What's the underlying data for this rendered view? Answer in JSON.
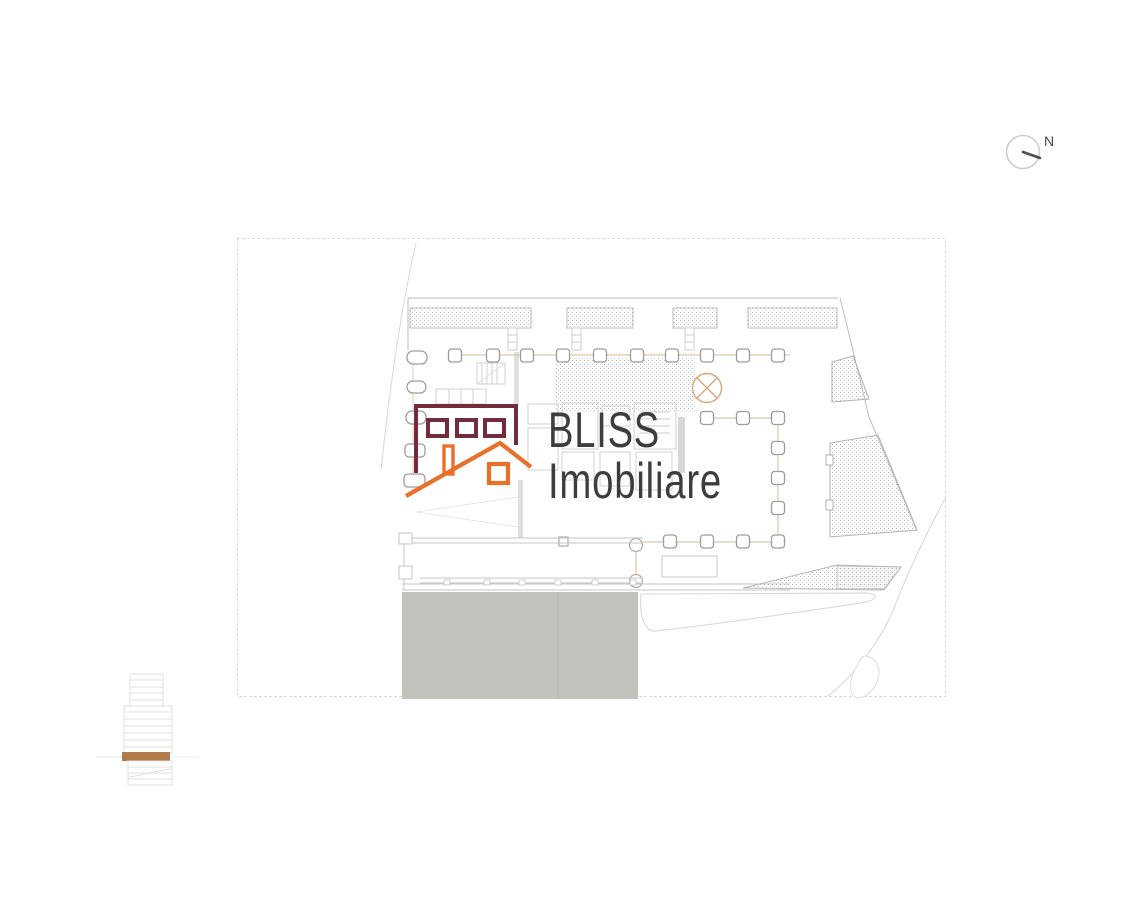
{
  "page": {
    "background_color": "#ffffff"
  },
  "watermark": {
    "line1": "BLISS",
    "line2": "Imobiliare",
    "text_color": "#3d3d3d",
    "house": {
      "building_color": "#722c3c",
      "roof_color": "#e8702a"
    }
  },
  "compass": {
    "label": "N",
    "label_color": "#4a4a4a",
    "ring_color": "#cdcdcd",
    "needle_color": "#4f4f4f"
  },
  "plan": {
    "boundary_color": "#c9c9c9",
    "slab_color": "#c3c2bd",
    "column_stroke_color": "#9d9d9d",
    "grid_line_color": "#ddb592",
    "hatch_dot_color": "#b3b3b3",
    "wall_color": "#c6c6c6"
  },
  "elevation_key": {
    "highlight_color": "#b07c4c",
    "line_color": "#e2e0de"
  }
}
